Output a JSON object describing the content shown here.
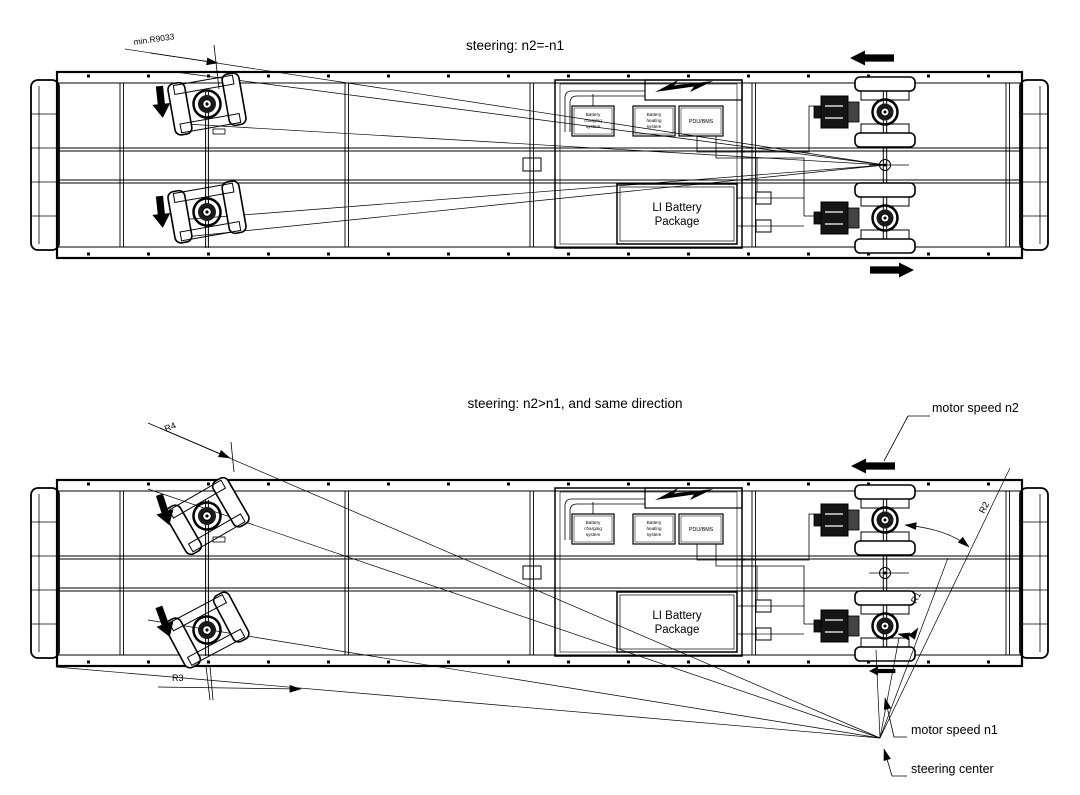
{
  "figure": {
    "diagram1": {
      "title": "steering: n2=-n1",
      "min_radius_label": "min.R9033"
    },
    "diagram2": {
      "title": "steering: n2>n1, and  same direction",
      "r1": "R1",
      "r2": "R2",
      "r3": "R3",
      "r4": "R4",
      "motor_speed_n2": "motor speed n2",
      "motor_speed_n1": "motor speed n1",
      "steering_center": "steering center"
    },
    "equipment": {
      "charging_line1": "Battery",
      "charging_line2": "charging",
      "charging_line3": "system",
      "heating_line1": "Battery",
      "heating_line2": "heating",
      "heating_line3": "system",
      "pdu": "PDU/BMS",
      "pack_line1": "LI Battery",
      "pack_line2": "Package"
    },
    "colors": {
      "ink": "#000000",
      "paper": "#ffffff"
    }
  }
}
